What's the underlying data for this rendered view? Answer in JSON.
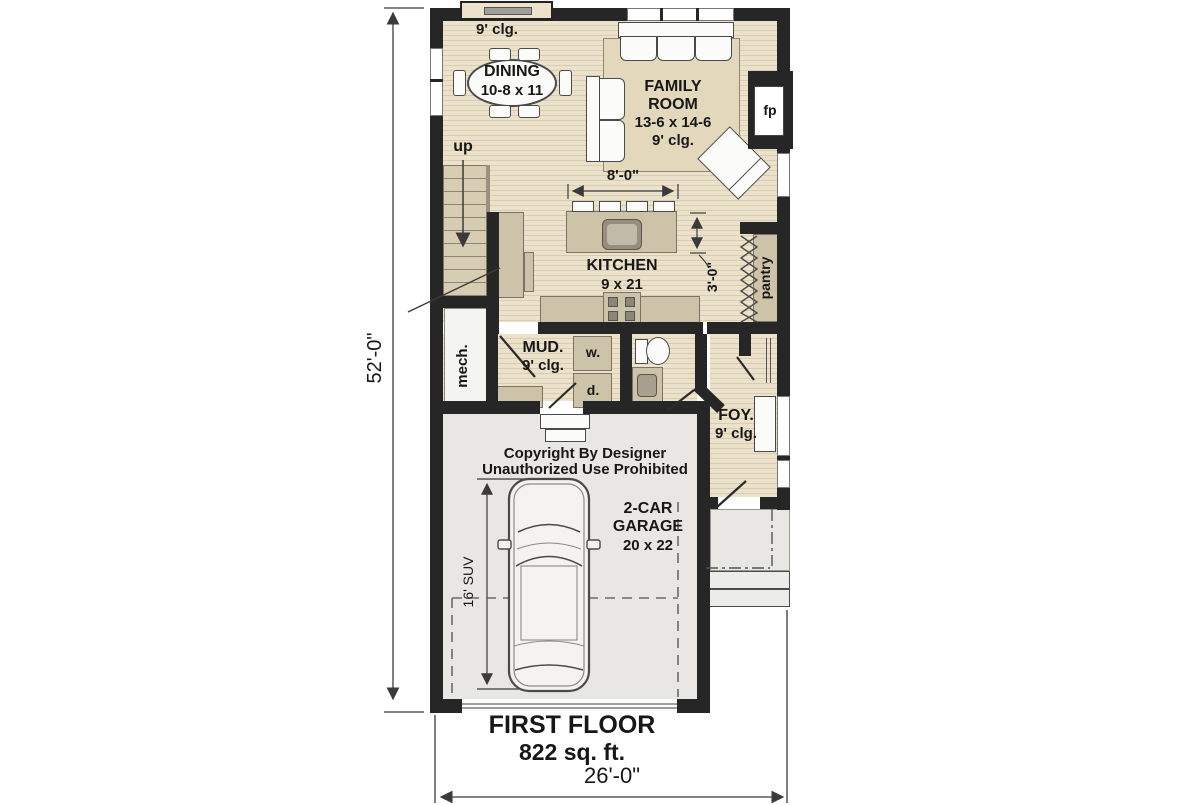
{
  "title": {
    "line1": "FIRST FLOOR",
    "line2": "822 sq. ft."
  },
  "copyright": {
    "line1": "Copyright By Designer",
    "line2": "Unauthorized Use Prohibited"
  },
  "dimensions": {
    "overall_depth": "52'-0\"",
    "overall_width": "26'-0\"",
    "island_clearance": "8'-0\"",
    "pantry_clearance": "3'-0\"",
    "suv_length": "16' SUV"
  },
  "rooms": {
    "dining": {
      "ceiling": "9' clg.",
      "name": "DINING",
      "size": "10-8 x 11"
    },
    "family_room": {
      "name_line1": "FAMILY",
      "name_line2": "ROOM",
      "size": "13-6 x 14-6",
      "ceiling": "9' clg."
    },
    "kitchen": {
      "name": "KITCHEN",
      "size": "9 x 21"
    },
    "mud_room": {
      "name": "MUD.",
      "ceiling": "9' clg."
    },
    "foyer": {
      "name": "FOY.",
      "ceiling": "9' clg."
    },
    "garage": {
      "name_line1": "2-CAR",
      "name_line2": "GARAGE",
      "size": "20 x 22"
    },
    "pantry": {
      "name": "pantry"
    },
    "mech": {
      "name": "mech."
    }
  },
  "labels": {
    "stairs_up": "up",
    "fireplace": "fp",
    "washer": "w.",
    "dryer": "d."
  },
  "colors": {
    "wall": "#262626",
    "floor_light": "#ece2cb",
    "floor_stripe": "#d9cdaf",
    "rug": "#e3d8bb",
    "cabinet": "#ccc3a9",
    "garage_floor": "#e8e7e4",
    "linework": "#3a3a3a"
  }
}
